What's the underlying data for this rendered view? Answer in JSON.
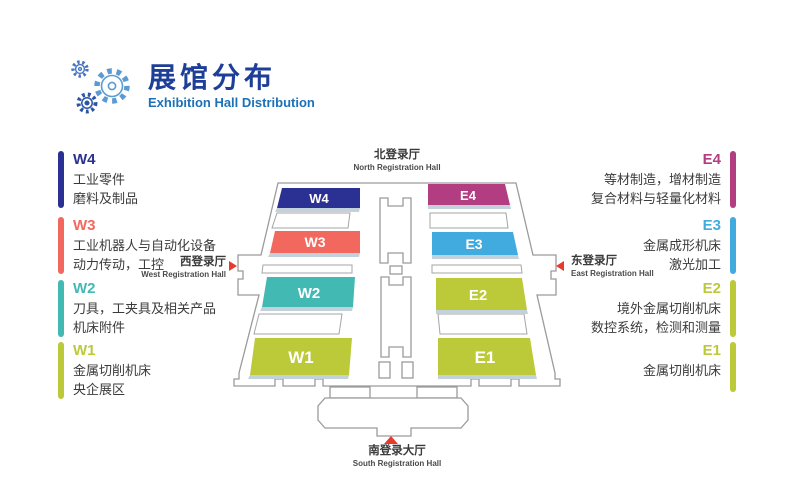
{
  "header": {
    "title": "展馆分布",
    "subtitle": "Exhibition Hall Distribution"
  },
  "legend_west": [
    {
      "code": "W4",
      "color": "#2b3193",
      "lines": [
        "工业零件",
        "磨料及制品"
      ]
    },
    {
      "code": "W3",
      "color": "#f2685e",
      "lines": [
        "工业机器人与自动化设备",
        "动力传动，工控"
      ]
    },
    {
      "code": "W2",
      "color": "#43b9b4",
      "lines": [
        "刀具，工夹具及相关产品",
        "机床附件"
      ]
    },
    {
      "code": "W1",
      "color": "#bcc938",
      "lines": [
        "金属切削机床",
        "央企展区"
      ]
    }
  ],
  "legend_east": [
    {
      "code": "E4",
      "color": "#b23d81",
      "lines": [
        "等材制造，增材制造",
        "复合材料与轻量化材料"
      ]
    },
    {
      "code": "E3",
      "color": "#41abdf",
      "lines": [
        "金属成形机床",
        "激光加工"
      ]
    },
    {
      "code": "E2",
      "color": "#bcc938",
      "lines": [
        "境外金属切削机床",
        "数控系统，检测和测量"
      ]
    },
    {
      "code": "E1",
      "color": "#bcc938",
      "lines": [
        "金属切削机床"
      ]
    }
  ],
  "map": {
    "halls": [
      {
        "code": "W4",
        "color": "#2b3193"
      },
      {
        "code": "W3",
        "color": "#f2685e"
      },
      {
        "code": "W2",
        "color": "#43b9b4"
      },
      {
        "code": "W1",
        "color": "#bcc938"
      },
      {
        "code": "E4",
        "color": "#b23d81"
      },
      {
        "code": "E3",
        "color": "#41abdf"
      },
      {
        "code": "E2",
        "color": "#bcc938"
      },
      {
        "code": "E1",
        "color": "#bcc938"
      }
    ],
    "entrances": {
      "north": {
        "zh": "北登录厅",
        "en": "North Registration Hall"
      },
      "south": {
        "zh": "南登录大厅",
        "en": "South Registration Hall"
      },
      "west": {
        "zh": "西登录厅",
        "en": "West Registration Hall"
      },
      "east": {
        "zh": "东登录厅",
        "en": "East Registration Hall"
      }
    },
    "arrow_color": "#e93b2d",
    "outline_color": "#9b9b9b",
    "shadow_color": "#c3d2da"
  }
}
